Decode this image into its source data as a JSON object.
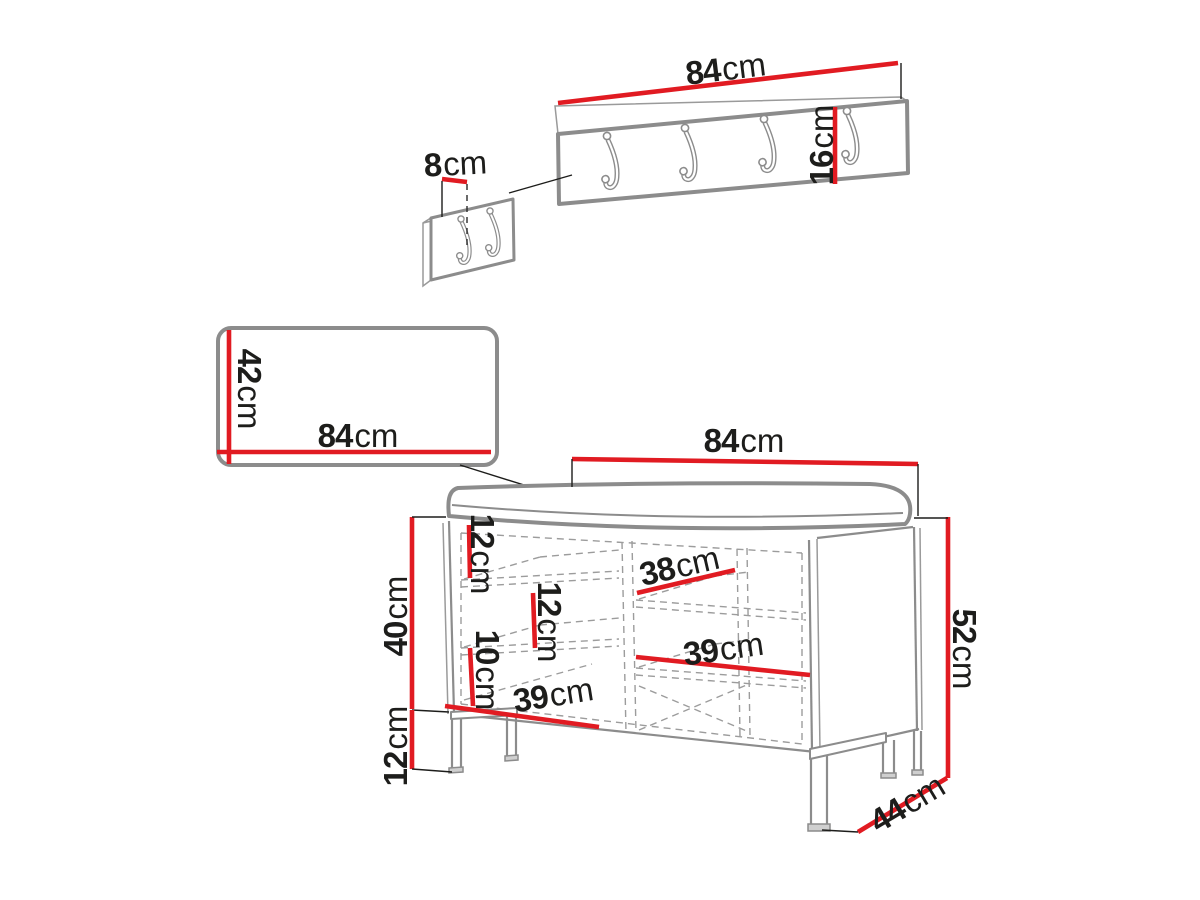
{
  "diagram": {
    "background": "#ffffff",
    "colors": {
      "dimension": "#e11b22",
      "furniture_outline": "#8c8c8c",
      "label_text": "#1d1d1b"
    },
    "coat_rack": {
      "width": {
        "value": "84",
        "unit": "cm"
      },
      "height": {
        "value": "16",
        "unit": "cm"
      }
    },
    "hook_detail": {
      "offset": {
        "value": "8",
        "unit": "cm"
      }
    },
    "panel": {
      "width": {
        "value": "84",
        "unit": "cm"
      },
      "height": {
        "value": "42",
        "unit": "cm"
      }
    },
    "bench": {
      "width": {
        "value": "84",
        "unit": "cm"
      },
      "total_height": {
        "value": "52",
        "unit": "cm"
      },
      "body_height": {
        "value": "40",
        "unit": "cm"
      },
      "leg_height": {
        "value": "12",
        "unit": "cm"
      },
      "depth": {
        "value": "44",
        "unit": "cm"
      },
      "top_shelf_gap": {
        "value": "12",
        "unit": "cm"
      },
      "middle_shelf_gap": {
        "value": "12",
        "unit": "cm"
      },
      "bottom_shelf_gap": {
        "value": "10",
        "unit": "cm"
      },
      "shelf_depth": {
        "value": "38",
        "unit": "cm"
      },
      "right_compartment_width": {
        "value": "39",
        "unit": "cm"
      },
      "left_compartment_width": {
        "value": "39",
        "unit": "cm"
      }
    }
  }
}
